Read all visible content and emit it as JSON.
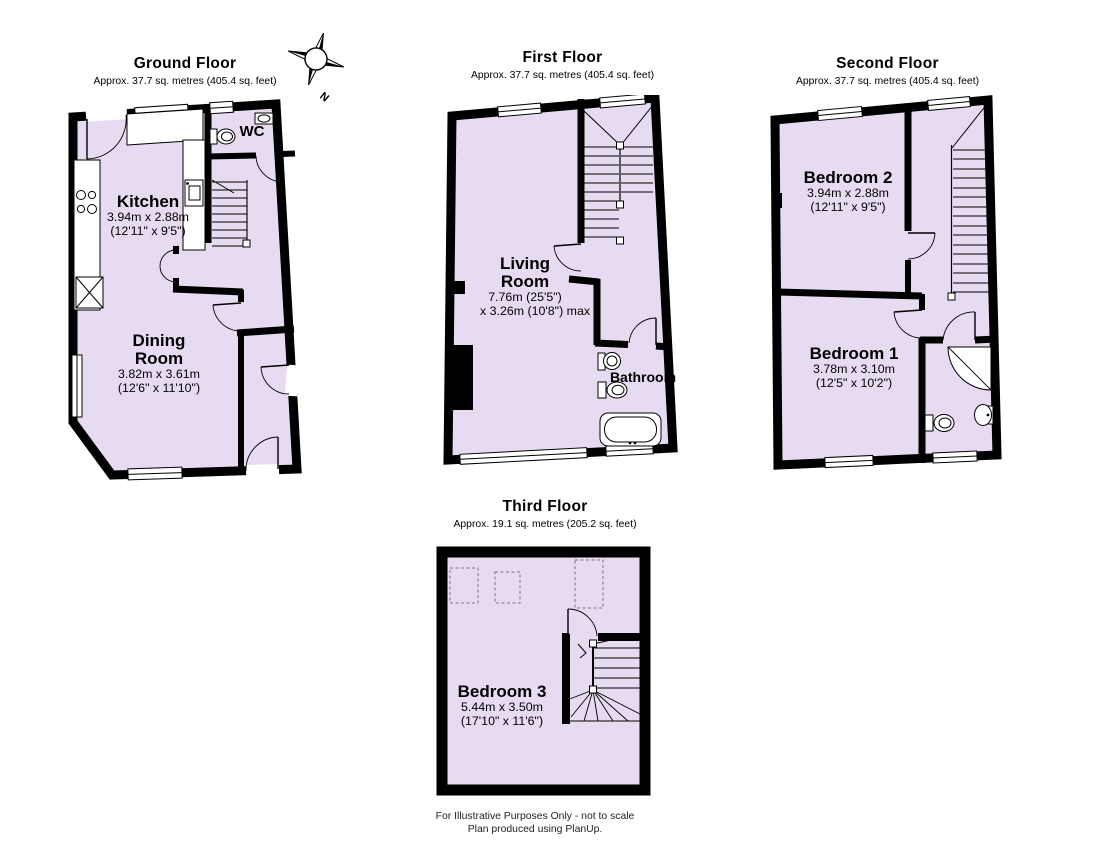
{
  "page": {
    "background": "#ffffff",
    "wall_color": "#000000",
    "room_fill": "#e7dbf2"
  },
  "compass": {
    "label": "N"
  },
  "floors": {
    "ground": {
      "title": "Ground Floor",
      "subtitle": "Approx. 37.7 sq. metres (405.4 sq. feet)",
      "rooms": {
        "kitchen": {
          "name": "Kitchen",
          "metric": "3.94m x 2.88m",
          "imperial": "(12'11\" x 9'5\")"
        },
        "dining_room": {
          "name": "Dining Room",
          "metric": "3.82m x 3.61m",
          "imperial": "(12'6\" x 11'10\")"
        },
        "wc": {
          "name": "WC"
        }
      }
    },
    "first": {
      "title": "First Floor",
      "subtitle": "Approx. 37.7 sq. metres (405.4 sq. feet)",
      "rooms": {
        "living_room": {
          "name": "Living Room",
          "metric": "7.76m (25'5\")",
          "imperial": "x 3.26m (10'8\") max"
        },
        "bathroom": {
          "name": "Bathroom"
        }
      }
    },
    "second": {
      "title": "Second Floor",
      "subtitle": "Approx. 37.7 sq. metres (405.4 sq. feet)",
      "rooms": {
        "bedroom2": {
          "name": "Bedroom 2",
          "metric": "3.94m x 2.88m",
          "imperial": "(12'11\" x 9'5\")"
        },
        "bedroom1": {
          "name": "Bedroom 1",
          "metric": "3.78m x 3.10m",
          "imperial": "(12'5\" x 10'2\")"
        }
      }
    },
    "third": {
      "title": "Third Floor",
      "subtitle": "Approx. 19.1 sq. metres (205.2 sq. feet)",
      "rooms": {
        "bedroom3": {
          "name": "Bedroom 3",
          "metric": "5.44m x 3.50m",
          "imperial": "(17'10\" x 11'6\")"
        }
      }
    }
  },
  "footer": {
    "line1": "For Illustrative Purposes Only - not to scale",
    "line2": "Plan produced using PlanUp."
  }
}
